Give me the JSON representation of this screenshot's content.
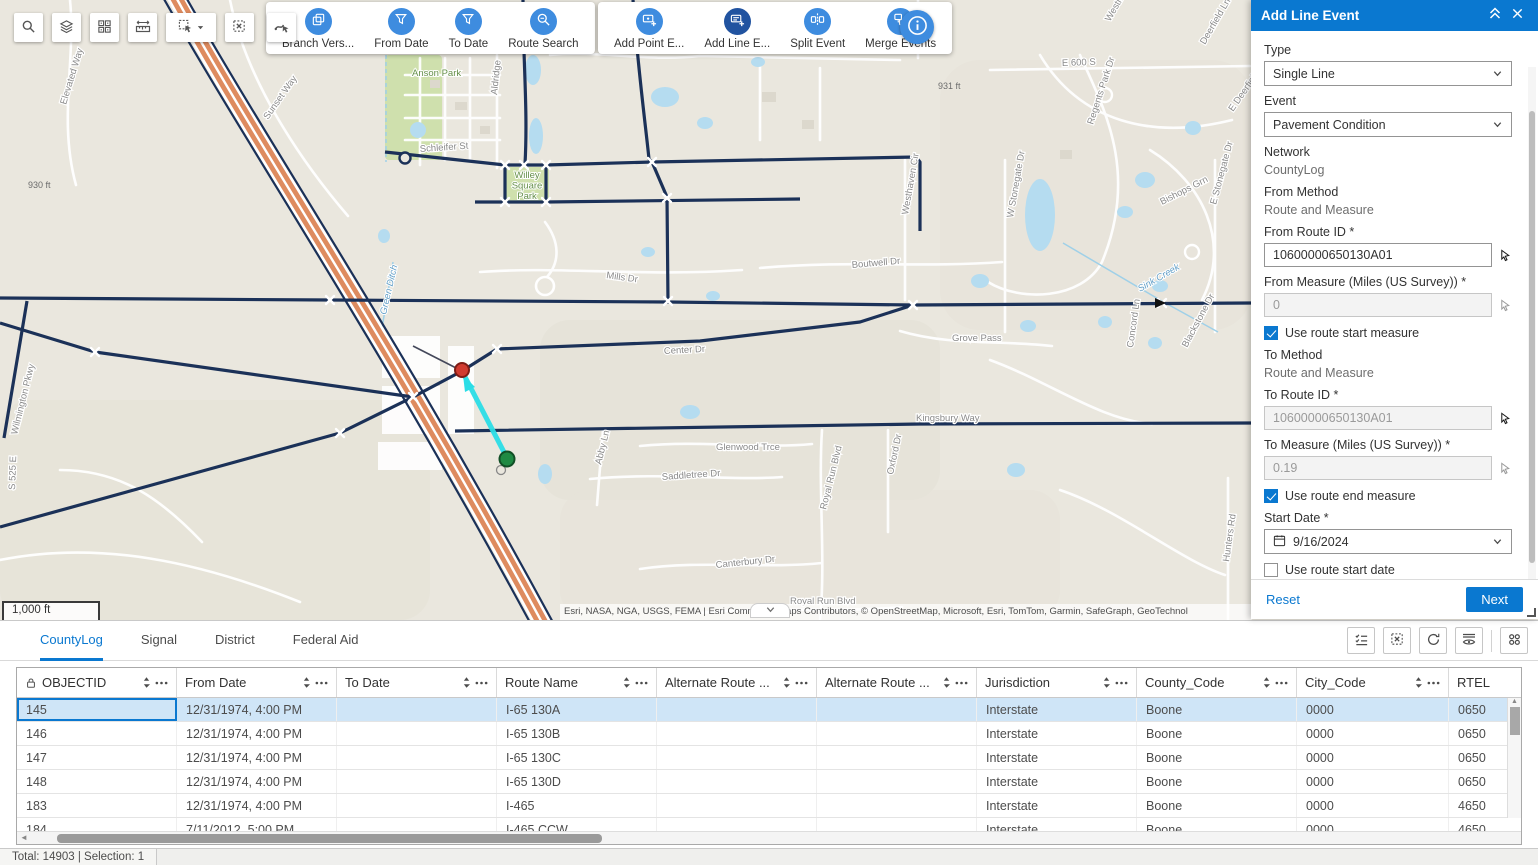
{
  "colors": {
    "primary_blue": "#0a78d0",
    "tool_circle_blue": "#3e8cdf",
    "tool_circle_active": "#2153a0",
    "route_navy": "#1b3158",
    "highway_orange": "#de8b5f",
    "selection_cyan": "#2bdde6",
    "selected_row": "#cfe5f7",
    "map_background": "#eae7de",
    "water": "#b5dcf0"
  },
  "map_toolbar": {
    "buttons": [
      {
        "name": "search-tool-button",
        "icon": "magnifier-icon"
      },
      {
        "name": "layers-tool-button",
        "icon": "layers-icon"
      },
      {
        "name": "basemap-tool-button",
        "icon": "basemap-grid-icon"
      },
      {
        "name": "measure-tool-button",
        "icon": "measure-icon"
      },
      {
        "name": "select-tool-button",
        "icon": "select-cursor-icon",
        "dropdown": true
      },
      {
        "name": "clear-selection-tool-button",
        "icon": "clear-selection-icon"
      },
      {
        "name": "select-events-tool-button",
        "icon": "route-cursor-icon"
      }
    ],
    "cards": [
      {
        "tools": [
          {
            "label": "Branch Vers...",
            "icon": "branch-versions-icon",
            "active": false
          },
          {
            "label": "From Date",
            "icon": "filter-icon",
            "active": false
          },
          {
            "label": "To Date",
            "icon": "filter-icon",
            "active": false
          },
          {
            "label": "Route Search",
            "icon": "route-search-icon",
            "active": false
          }
        ]
      },
      {
        "tools": [
          {
            "label": "Add Point E...",
            "icon": "add-point-event-icon",
            "active": false
          },
          {
            "label": "Add Line E...",
            "icon": "add-line-event-icon",
            "active": true
          },
          {
            "label": "Split Event",
            "icon": "split-event-icon",
            "active": false
          },
          {
            "label": "Merge Events",
            "icon": "merge-events-icon",
            "active": false
          }
        ]
      }
    ]
  },
  "map": {
    "scale_bar": "1,000 ft",
    "attribution": "Esri, NASA, NGA, USGS, FEMA | Esri Community Maps Contributors, © OpenStreetMap, Microsoft, Esri, TomTom, Garmin, SafeGraph, GeoTechnol",
    "labels": [
      {
        "text": "Elevated Way",
        "x": 66,
        "y": 105,
        "rot": -73,
        "kind": "road"
      },
      {
        "text": "Sunset Way",
        "x": 268,
        "y": 120,
        "rot": -55,
        "kind": "road"
      },
      {
        "text": "Anson Park",
        "x": 412,
        "y": 76,
        "rot": 0,
        "kind": "park"
      },
      {
        "text": "Willey Square Park",
        "x": 527,
        "y": 178,
        "rot": 0,
        "kind": "park",
        "multiline": true
      },
      {
        "text": "Aldridge",
        "x": 497,
        "y": 95,
        "rot": -84,
        "kind": "road"
      },
      {
        "text": "Schleifer St",
        "x": 420,
        "y": 152,
        "rot": -4,
        "kind": "road"
      },
      {
        "text": "931 ft",
        "x": 938,
        "y": 89,
        "rot": 0,
        "kind": "elev"
      },
      {
        "text": "930 ft",
        "x": 28,
        "y": 188,
        "rot": 0,
        "kind": "elev"
      },
      {
        "text": "S 700 E",
        "x": 921,
        "y": 52,
        "rot": -88,
        "kind": "road"
      },
      {
        "text": "E 600 S",
        "x": 1062,
        "y": 66,
        "rot": -2,
        "kind": "road"
      },
      {
        "text": "Westminster",
        "x": 1110,
        "y": 22,
        "rot": -60,
        "kind": "road"
      },
      {
        "text": "Deerfield Ln",
        "x": 1205,
        "y": 45,
        "rot": -60,
        "kind": "road"
      },
      {
        "text": "E Deerfield Dr",
        "x": 1233,
        "y": 112,
        "rot": -55,
        "kind": "road"
      },
      {
        "text": "Regents Park Dr",
        "x": 1093,
        "y": 125,
        "rot": -72,
        "kind": "road"
      },
      {
        "text": "Bishops Grn",
        "x": 1162,
        "y": 205,
        "rot": -27,
        "kind": "road"
      },
      {
        "text": "E Stonegate Dr",
        "x": 1216,
        "y": 205,
        "rot": -75,
        "kind": "road"
      },
      {
        "text": "W Stonegate Dr",
        "x": 1013,
        "y": 218,
        "rot": -80,
        "kind": "road"
      },
      {
        "text": "Westhaven Cir",
        "x": 908,
        "y": 215,
        "rot": -80,
        "kind": "road"
      },
      {
        "text": "Sink Creek",
        "x": 1140,
        "y": 292,
        "rot": -30,
        "kind": "water"
      },
      {
        "text": "Green Ditch",
        "x": 386,
        "y": 315,
        "rot": -77,
        "kind": "water"
      },
      {
        "text": "Mills Dr",
        "x": 606,
        "y": 278,
        "rot": 8,
        "kind": "road"
      },
      {
        "text": "Boutwell Dr",
        "x": 852,
        "y": 268,
        "rot": -5,
        "kind": "road"
      },
      {
        "text": "Center Dr",
        "x": 664,
        "y": 354,
        "rot": -3,
        "kind": "road"
      },
      {
        "text": "Grove Pass",
        "x": 952,
        "y": 341,
        "rot": 0,
        "kind": "road"
      },
      {
        "text": "Kingsbury Way",
        "x": 916,
        "y": 421,
        "rot": 0,
        "kind": "road"
      },
      {
        "text": "Blackstone Dr",
        "x": 1187,
        "y": 348,
        "rot": -62,
        "kind": "road"
      },
      {
        "text": "Concord Ln",
        "x": 1133,
        "y": 348,
        "rot": -82,
        "kind": "road"
      },
      {
        "text": "Glenwood Trce",
        "x": 716,
        "y": 450,
        "rot": 0,
        "kind": "road"
      },
      {
        "text": "Saddletree Dr",
        "x": 662,
        "y": 480,
        "rot": -4,
        "kind": "road"
      },
      {
        "text": "Abby Ln",
        "x": 601,
        "y": 465,
        "rot": -76,
        "kind": "road"
      },
      {
        "text": "Royal Run Blvd",
        "x": 826,
        "y": 510,
        "rot": -76,
        "kind": "road"
      },
      {
        "text": "Oxford Dr",
        "x": 893,
        "y": 475,
        "rot": -78,
        "kind": "road"
      },
      {
        "text": "Canterbury Dr",
        "x": 716,
        "y": 568,
        "rot": -6,
        "kind": "road"
      },
      {
        "text": "Royal Run Blvd",
        "x": 790,
        "y": 604,
        "rot": 0,
        "kind": "road"
      },
      {
        "text": "Hunters Rd",
        "x": 1229,
        "y": 562,
        "rot": -82,
        "kind": "road"
      },
      {
        "text": "Wilmington Pkwy",
        "x": 17,
        "y": 435,
        "rot": -76,
        "kind": "road"
      },
      {
        "text": "S 525 E",
        "x": 15,
        "y": 490,
        "rot": -88,
        "kind": "road"
      }
    ]
  },
  "panel": {
    "title": "Add Line Event",
    "type_label": "Type",
    "type_value": "Single Line",
    "event_label": "Event",
    "event_value": "Pavement Condition",
    "network_label": "Network",
    "network_value": "CountyLog",
    "from_method_label": "From Method",
    "from_method_value": "Route and Measure",
    "from_route_label": "From Route ID *",
    "from_route_value": "10600000650130A01",
    "from_measure_label": "From Measure (Miles (US Survey)) *",
    "from_measure_value": "0",
    "use_route_start_measure": {
      "label": "Use route start measure",
      "checked": true
    },
    "to_method_label": "To Method",
    "to_method_value": "Route and Measure",
    "to_route_label": "To Route ID *",
    "to_route_value": "10600000650130A01",
    "to_measure_label": "To Measure (Miles (US Survey)) *",
    "to_measure_value": "0.19",
    "use_route_end_measure": {
      "label": "Use route end measure",
      "checked": true
    },
    "start_date_label": "Start Date *",
    "start_date_value": "9/16/2024",
    "use_route_start_date": {
      "label": "Use route start date",
      "checked": false
    },
    "end_date_label": "End Date",
    "end_date_placeholder": "MM/DD/YYYY",
    "use_route_end_date": {
      "label": "Use route end date",
      "checked": false
    },
    "reset_label": "Reset",
    "next_label": "Next"
  },
  "table": {
    "tabs": [
      {
        "label": "CountyLog",
        "active": true
      },
      {
        "label": "Signal",
        "active": false
      },
      {
        "label": "District",
        "active": false
      },
      {
        "label": "Federal Aid",
        "active": false
      }
    ],
    "toolbar_icons": [
      "show-selected-icon",
      "clear-table-selection-icon",
      "refresh-icon",
      "hide-columns-icon",
      "grid-options-icon"
    ],
    "columns": [
      {
        "label": "OBJECTID",
        "locked": true
      },
      {
        "label": "From Date"
      },
      {
        "label": "To Date"
      },
      {
        "label": "Route Name"
      },
      {
        "label": "Alternate Route ..."
      },
      {
        "label": "Alternate Route ..."
      },
      {
        "label": "Jurisdiction"
      },
      {
        "label": "County_Code"
      },
      {
        "label": "City_Code"
      },
      {
        "label": "RTEL"
      }
    ],
    "rows": [
      {
        "selected": true,
        "cells": [
          "145",
          "12/31/1974, 4:00 PM",
          "",
          "I-65 130A",
          "",
          "",
          "Interstate",
          "Boone",
          "0000",
          "0650"
        ]
      },
      {
        "selected": false,
        "cells": [
          "146",
          "12/31/1974, 4:00 PM",
          "",
          "I-65 130B",
          "",
          "",
          "Interstate",
          "Boone",
          "0000",
          "0650"
        ]
      },
      {
        "selected": false,
        "cells": [
          "147",
          "12/31/1974, 4:00 PM",
          "",
          "I-65 130C",
          "",
          "",
          "Interstate",
          "Boone",
          "0000",
          "0650"
        ]
      },
      {
        "selected": false,
        "cells": [
          "148",
          "12/31/1974, 4:00 PM",
          "",
          "I-65 130D",
          "",
          "",
          "Interstate",
          "Boone",
          "0000",
          "0650"
        ]
      },
      {
        "selected": false,
        "cells": [
          "183",
          "12/31/1974, 4:00 PM",
          "",
          "I-465",
          "",
          "",
          "Interstate",
          "Boone",
          "0000",
          "4650"
        ]
      },
      {
        "selected": false,
        "cells": [
          "184",
          "7/11/2012, 5:00 PM",
          "",
          "I-465 CCW",
          "",
          "",
          "Interstate",
          "Boone",
          "0000",
          "4650"
        ]
      }
    ]
  },
  "status_bar": {
    "text": "Total: 14903 | Selection: 1"
  }
}
